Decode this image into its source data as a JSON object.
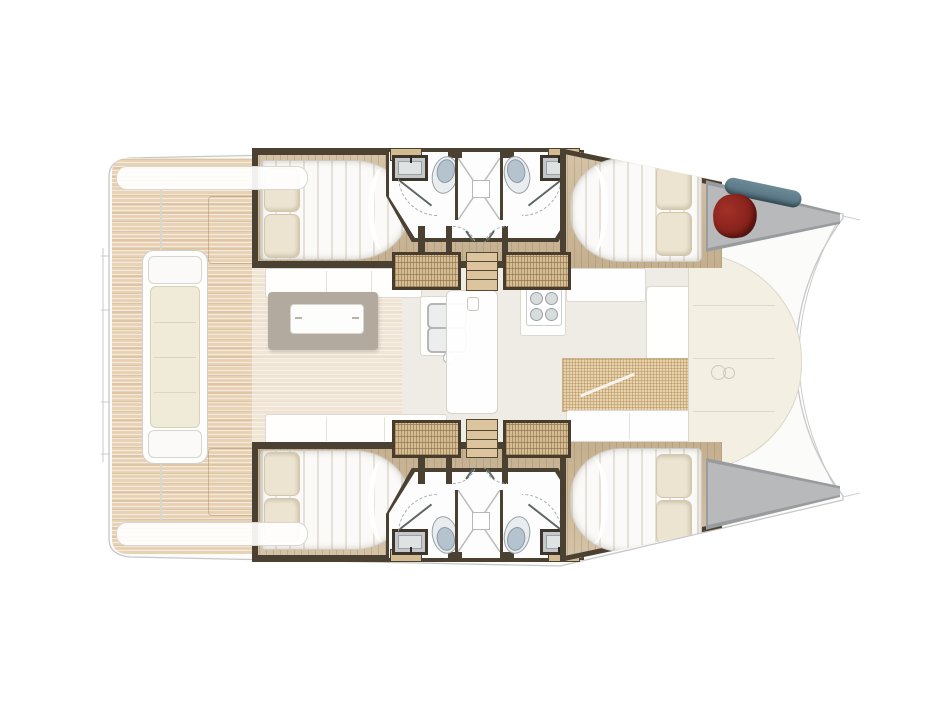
{
  "meta": {
    "title": "Catamaran deck plan",
    "view": "top-down",
    "orientation": "bow-right"
  },
  "colors": {
    "teak": "#e8d2b6",
    "wood": "#ccb795",
    "wall": "#4b4133",
    "tan": "#d3bb91",
    "stair": "#d5bc92",
    "mattress": "#fbfaf8",
    "pillow": "#ece4d0",
    "pillowEdge": "#d2c7ae",
    "bathFloor": "#fdfdfd",
    "lid": "#b5c3cf",
    "lidEdge": "#8d99a2",
    "sinkFrame": "#3e362b",
    "locker": "#b7b9ba",
    "lockerDark": "#999c9e",
    "red": "#801e18",
    "blue": "#5d7b8a",
    "ghostFloor": "#efece5",
    "cream": "#f3efe3",
    "creamEdge": "#dcd7c7",
    "mesh": "#e9d3ac",
    "meshLine": "#cdb288",
    "table": "#b3aa9f",
    "sofaEdge": "#dcd9d2",
    "outline": "#c6c8c7",
    "arc": "#a7acab"
  },
  "vessel": {
    "type": "catamaran",
    "areas": {
      "aft_deck": {
        "features": [
          "teak decking",
          "transom steps",
          "cockpit bench",
          "roof edge"
        ]
      },
      "salon": {
        "features": [
          "sofa",
          "dining table",
          "table tray",
          "galley double sink",
          "faucet"
        ]
      },
      "galley": {
        "features": [
          "stove with 4 burners",
          "counter",
          "cabinet"
        ]
      },
      "foredeck": {
        "features": [
          "lounge seats",
          "woven cushions",
          "sunpad panels",
          "winch emblem"
        ]
      },
      "hulls": [
        {
          "side": "port",
          "cabins": [
            "aft double berth with 2 pillows",
            "forward double berth with 2 pillows"
          ],
          "bathroom": [
            "sink",
            "toilet",
            "central shower",
            "toilet",
            "sink"
          ],
          "bow_locker": [
            "red gear bag",
            "blue fender"
          ]
        },
        {
          "side": "starboard",
          "cabins": [
            "aft double berth with 2 pillows",
            "forward double berth with 2 pillows"
          ],
          "bathroom": [
            "sink",
            "toilet",
            "central shower",
            "toilet",
            "sink"
          ],
          "bow_locker": []
        }
      ]
    },
    "counts": {
      "double_berths": 4,
      "toilets": 4,
      "hull_sinks": 4,
      "showers": 2,
      "companionways": 4
    }
  }
}
